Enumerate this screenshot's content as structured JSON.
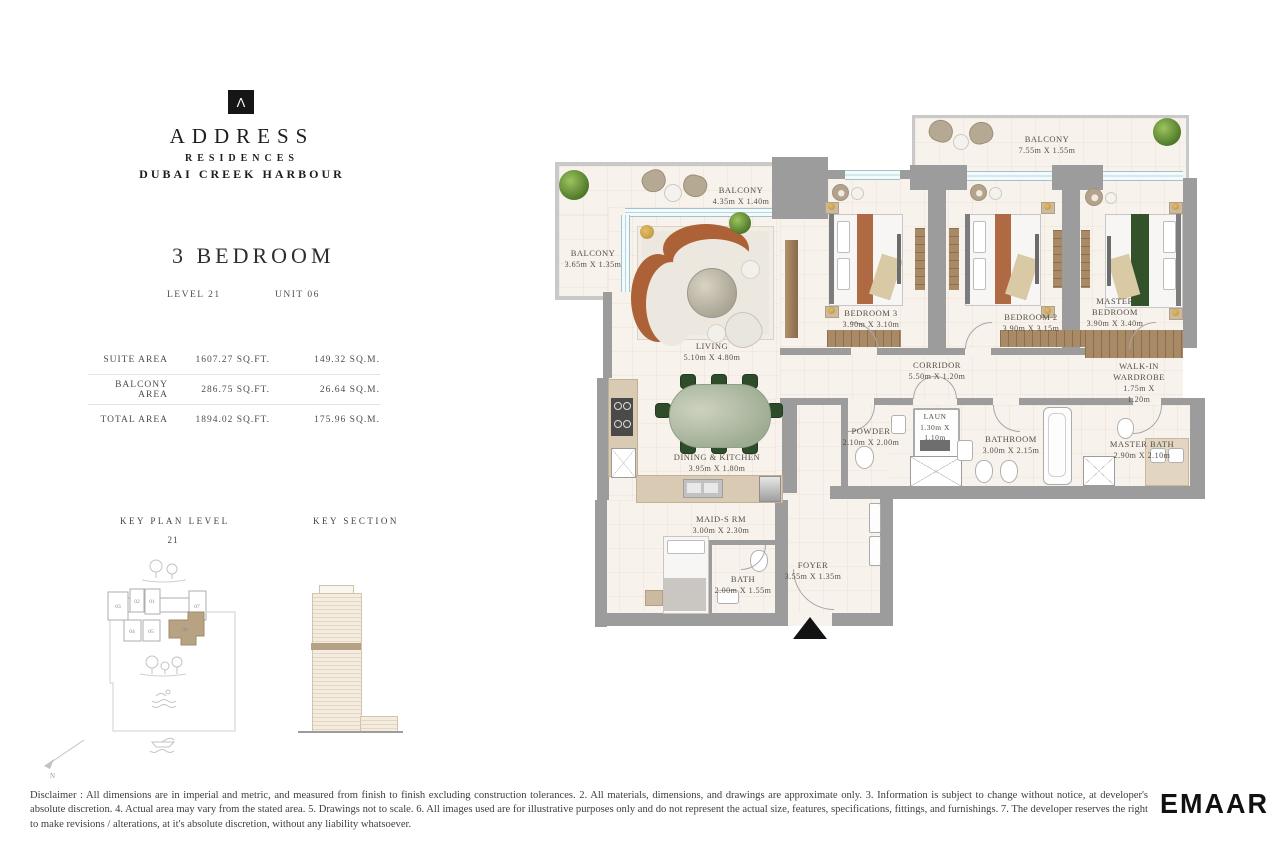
{
  "brand": {
    "logo_glyph": "Λ",
    "name": "ADDRESS",
    "line2": "RESIDENCES",
    "line3": "DUBAI CREEK HARBOUR"
  },
  "unit": {
    "type": "3 BEDROOM",
    "level": "LEVEL 21",
    "unit": "UNIT 06"
  },
  "area_table": {
    "rows": [
      {
        "label": "SUITE AREA",
        "sqft": "1607.27 SQ.FT.",
        "sqm": "149.32 SQ.M."
      },
      {
        "label": "BALCONY AREA",
        "sqft": "286.75 SQ.FT.",
        "sqm": "26.64 SQ.M."
      },
      {
        "label": "TOTAL AREA",
        "sqft": "1894.02 SQ.FT.",
        "sqm": "175.96 SQ.M."
      }
    ]
  },
  "key_plan": {
    "title": "KEY PLAN LEVEL",
    "level": "21",
    "units": [
      "01",
      "02",
      "03",
      "04",
      "05",
      "06",
      "07"
    ]
  },
  "key_section": {
    "title": "KEY SECTION"
  },
  "compass": {
    "label": "N"
  },
  "plan": {
    "rooms": [
      {
        "name": "BALCONY",
        "dims": "3.65m X 1.35m"
      },
      {
        "name": "BALCONY",
        "dims": "4.35m X 1.40m"
      },
      {
        "name": "BALCONY",
        "dims": "7.55m X 1.55m"
      },
      {
        "name": "LIVING",
        "dims": "5.10m X 4.80m"
      },
      {
        "name": "BEDROOM 3",
        "dims": "3.90m X 3.10m"
      },
      {
        "name": "BEDROOM 2",
        "dims": "3.90m X 3.15m"
      },
      {
        "name": "MASTER BEDROOM",
        "dims": "3.90m X 3.40m"
      },
      {
        "name": "CORRIDOR",
        "dims": "5.50m X 1.20m"
      },
      {
        "name": "WALK-IN WARDROBE",
        "dims": "1.75m X 1.20m"
      },
      {
        "name": "POWDER",
        "dims": "2.10m X 2.00m"
      },
      {
        "name": "LAUN",
        "dims": "1.30m X 1.10m"
      },
      {
        "name": "BATHROOM",
        "dims": "3.00m X 2.15m"
      },
      {
        "name": "MASTER BATH",
        "dims": "2.90m X 2.10m"
      },
      {
        "name": "DINING & KITCHEN",
        "dims": "3.95m X 1.80m"
      },
      {
        "name": "MAID-S RM",
        "dims": "3.00m X 2.30m"
      },
      {
        "name": "BATH",
        "dims": "2.00m X 1.55m"
      },
      {
        "name": "FOYER",
        "dims": "3.55m X 1.35m"
      }
    ]
  },
  "footer": {
    "disclaimer": "Disclaimer : All dimensions are in imperial and metric, and measured from finish to finish excluding construction tolerances. 2. All materials, dimensions, and drawings are approximate only. 3. Information is subject to change without notice, at developer's absolute discretion. 4. Actual area may vary from the stated area. 5. Drawings not to scale. 6. All images used are for illustrative purposes only and do not represent the actual size, features, specifications, fittings, and furnishings. 7. The developer reserves the right to make revisions / alterations, at it's absolute discretion, without any liability whatsoever.",
    "logo": "EMAAR"
  },
  "colors": {
    "wall": "#9c9c9c",
    "balcony_wall": "#c9c9c9",
    "floor": "#f8f2ec",
    "highlight_tan": "#b5a284",
    "sofa_orange": "#ad6136",
    "dining_green": "#2e4c2a",
    "wood": "#9a7b5c",
    "window_blue": "#9fc4cc"
  }
}
